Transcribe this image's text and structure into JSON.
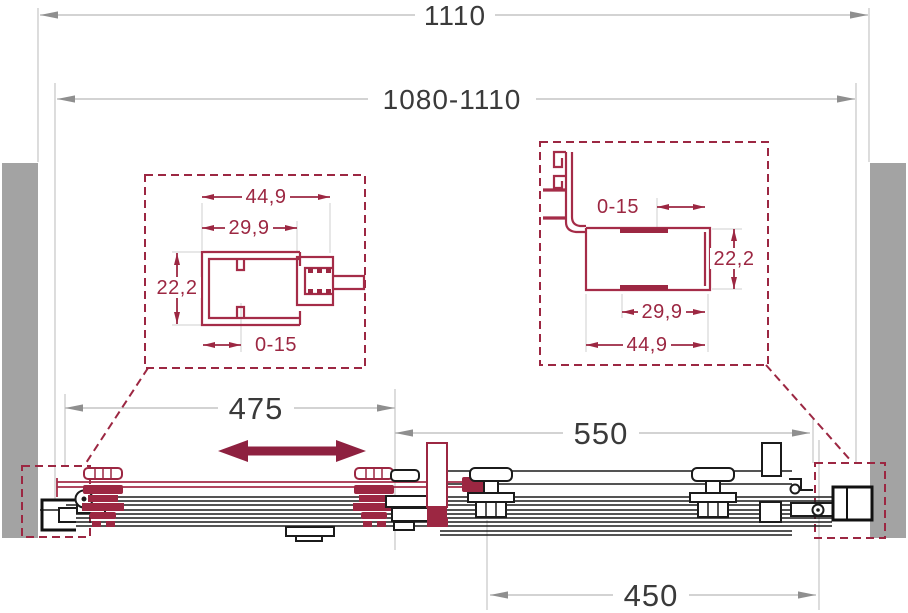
{
  "dimensions": {
    "overall_width": "1110",
    "adjustable_range": "1080-1110",
    "door_panel": "475",
    "fixed_panel": "550",
    "opening": "450"
  },
  "left_profile_detail": {
    "outer_width": "44,9",
    "inner_width": "29,9",
    "height": "22,2",
    "adjust_range": "0-15"
  },
  "right_profile_detail": {
    "adjust_range": "0-15",
    "height": "22,2",
    "inner_width": "29,9",
    "outer_width": "44,9"
  },
  "colors": {
    "accent": "#9c2742",
    "accent_dark": "#8e2140",
    "wall_gray": "#a3a3a3",
    "dim_line": "#c6c6c6",
    "dim_arrow": "#8f8f8f",
    "dim_text": "#3a3a3a",
    "line_black": "#1b1b1b"
  }
}
